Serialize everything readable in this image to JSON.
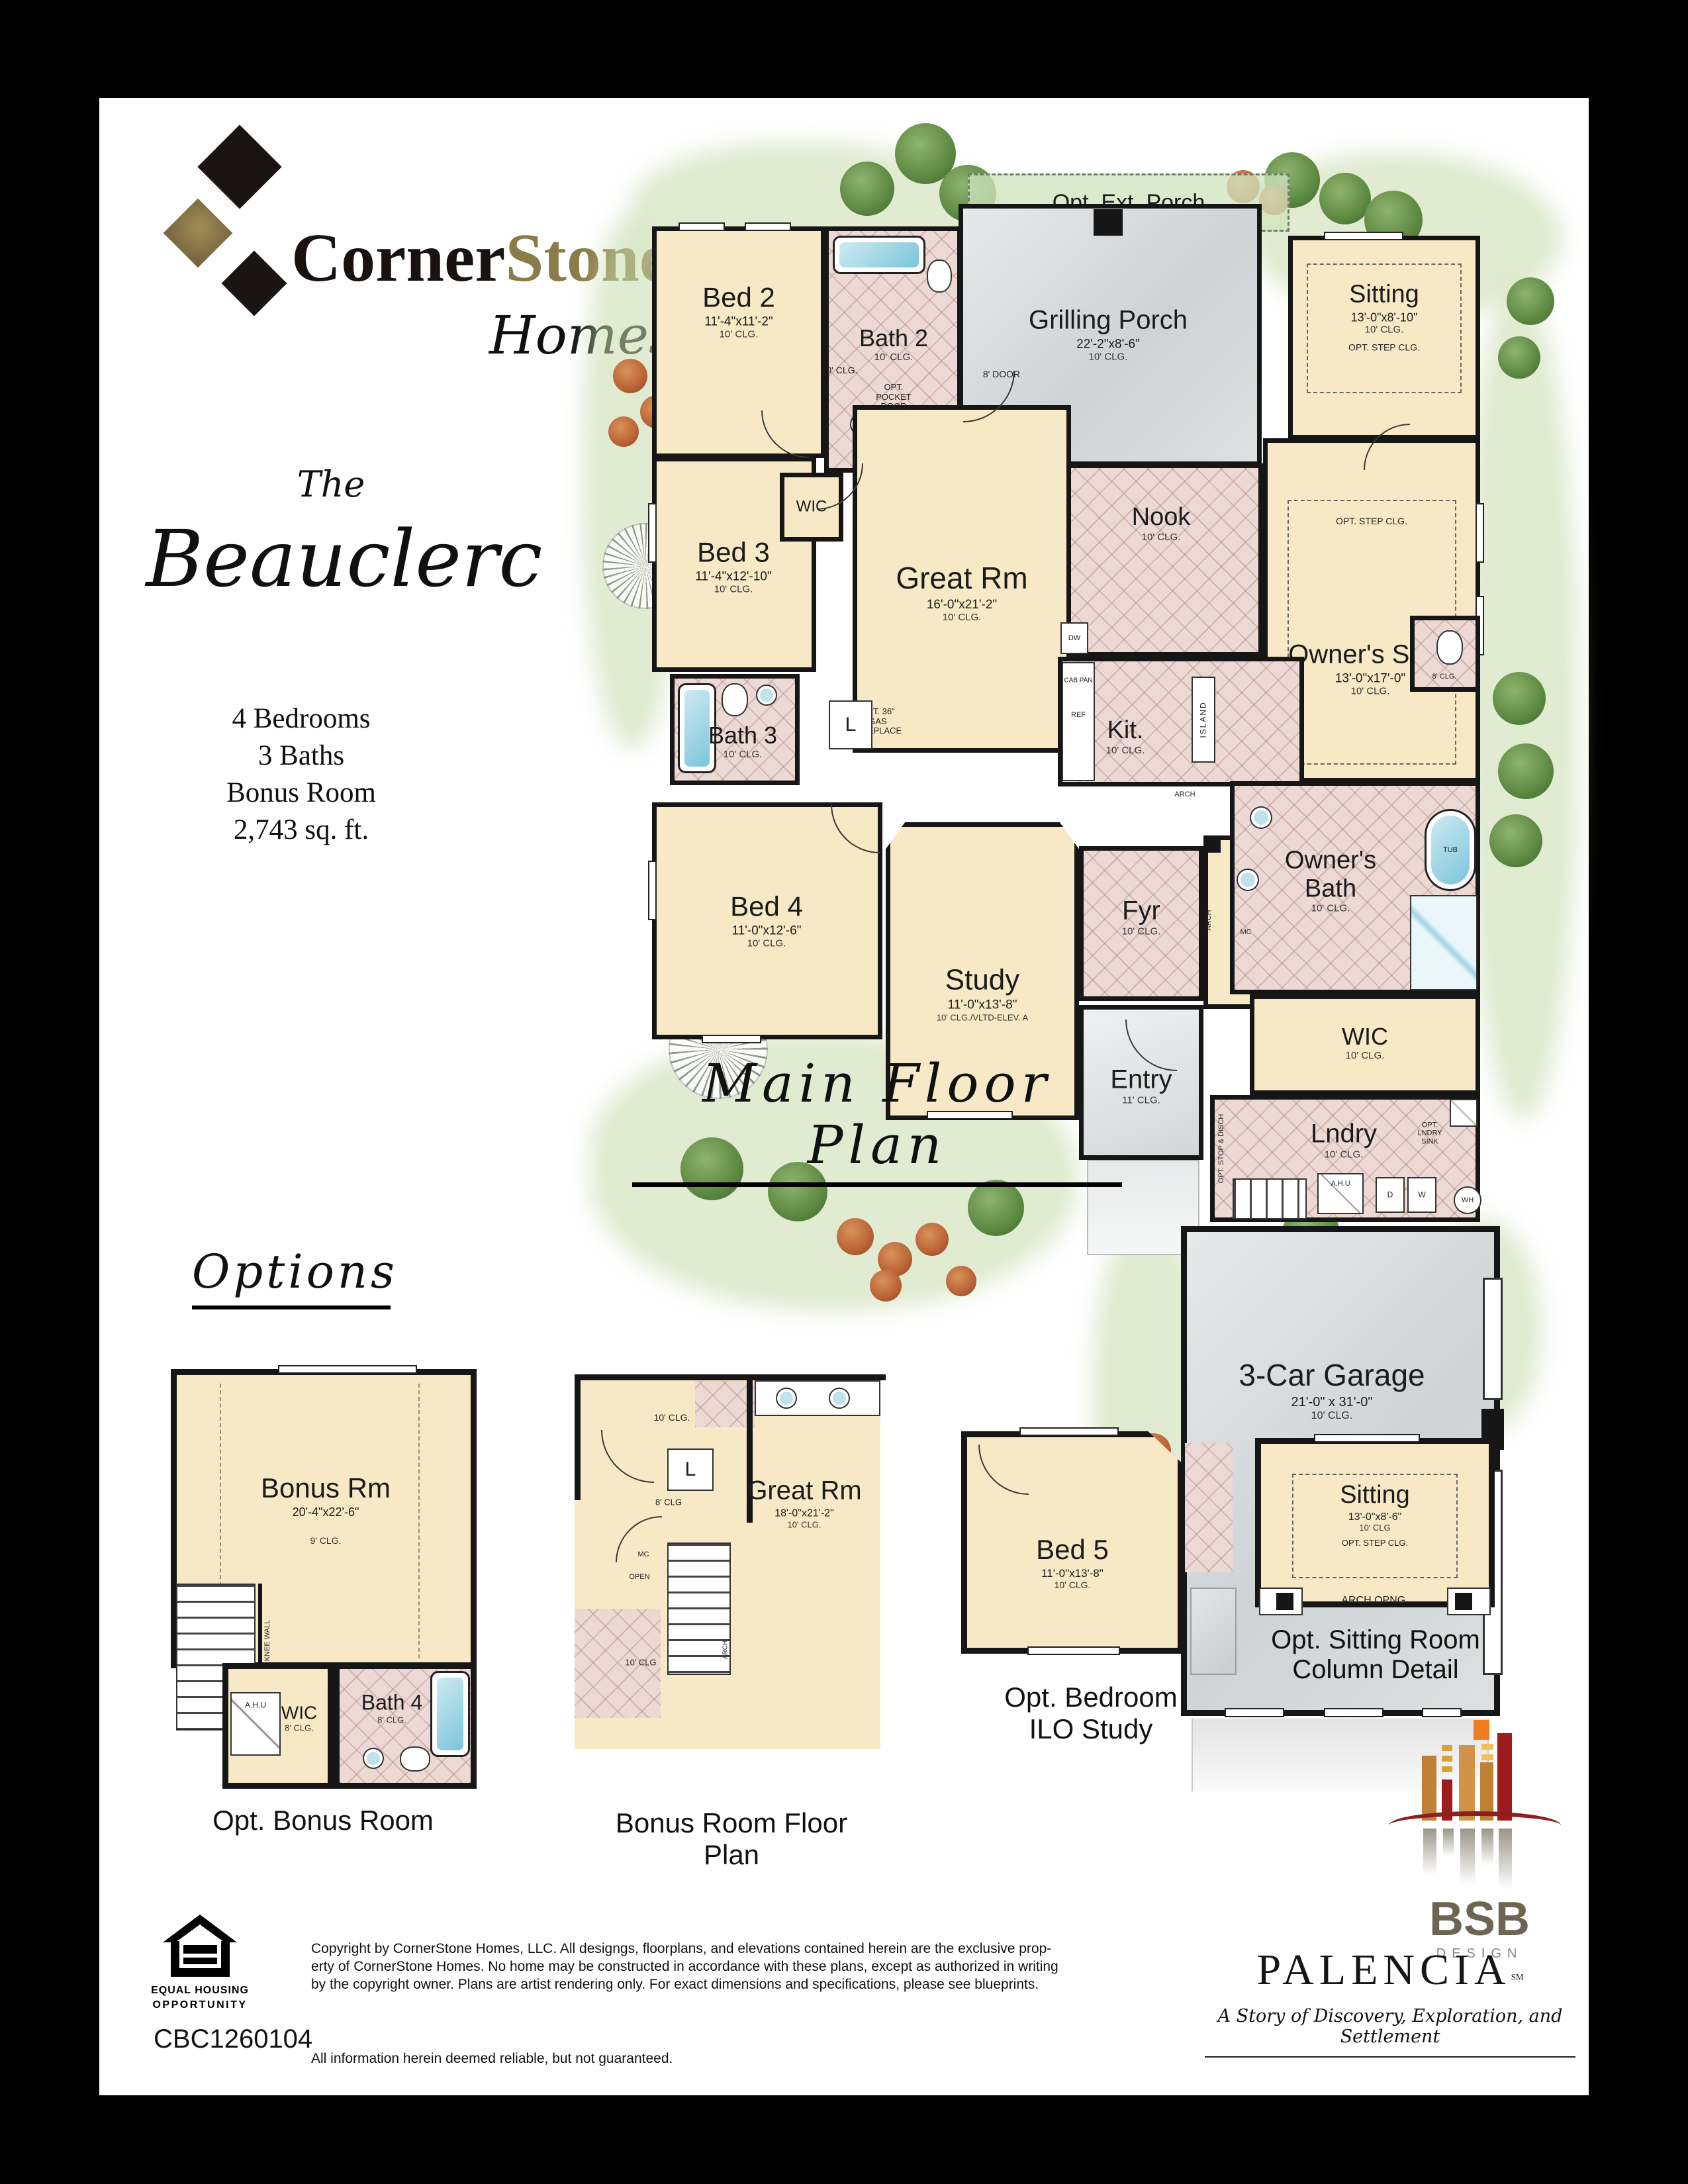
{
  "logo": {
    "corner": "Corner",
    "stone": "Stone",
    "homes": "Homes"
  },
  "title": {
    "the": "The",
    "name": "Beauclerc",
    "spec1": "4 Bedrooms",
    "spec2": "3 Baths",
    "spec3": "Bonus Room",
    "spec4": "2,743 sq. ft."
  },
  "headings": {
    "main": "Main Floor Plan",
    "options": "Options"
  },
  "plan": {
    "opt_ext_porch": "Opt. Ext. Porch",
    "grilling": {
      "name": "Grilling Porch",
      "dims": "22'-2\"x8'-6\"",
      "clg": "10' CLG."
    },
    "door8": "8' DOOR",
    "bed2": {
      "name": "Bed 2",
      "dims": "11'-4\"x11'-2\"",
      "clg": "10' CLG."
    },
    "bath2": {
      "name": "Bath 2",
      "clg": "10' CLG."
    },
    "sitting": {
      "name": "Sitting",
      "dims": "13'-0\"x8'-10\"",
      "clg": "10' CLG.",
      "opt": "OPT. STEP CLG."
    },
    "nook": {
      "name": "Nook",
      "clg": "10' CLG."
    },
    "suite": {
      "name": "Owner's Suite",
      "dims": "13'-0\"x17'-0\"",
      "clg": "10' CLG.",
      "opt": "OPT. STEP CLG."
    },
    "bed3": {
      "name": "Bed 3",
      "dims": "11'-4\"x12'-10\"",
      "clg": "10' CLG."
    },
    "wic_small": "WIC",
    "great": {
      "name": "Great Rm",
      "dims": "16'-0\"x21'-2\"",
      "clg": "10' CLG."
    },
    "pocket1": "OPT.",
    "pocket2": "POCKET",
    "pocket3": "DOOR",
    "fire1": "OPT. 36\"",
    "fire2": "GAS",
    "fire3": "FIREPLACE",
    "hall_clg": "10' CLG.",
    "linen": "L",
    "kit": {
      "name": "Kit.",
      "clg": "10' CLG.",
      "island": "ISLAND",
      "dw": "DW",
      "ref": "REF",
      "cab": "CAB PAN"
    },
    "bath3": {
      "name": "Bath 3",
      "clg": "10' CLG."
    },
    "bed4": {
      "name": "Bed 4",
      "dims": "11'-0\"x12'-6\"",
      "clg": "10' CLG."
    },
    "study": {
      "name": "Study",
      "dims": "11'-0\"x13'-8\"",
      "clg": "10' CLG./VLTD-ELEV. A"
    },
    "fyr": {
      "name": "Fyr",
      "clg": "10' CLG."
    },
    "dining": {
      "name": "Dining Rm",
      "dims": "10'-10\"x11'-6\"",
      "clg": "10' CLG."
    },
    "entry": {
      "name": "Entry",
      "clg": "11' CLG."
    },
    "obath": {
      "name1": "Owner's",
      "name2": "Bath",
      "clg": "10' CLG.",
      "tub": "TUB",
      "mc": "MC",
      "wc_clg": "8' CLG."
    },
    "wic": {
      "name": "WIC",
      "clg": "10' CLG."
    },
    "lndry": {
      "name": "Lndry",
      "clg": "10' CLG.",
      "sink1": "OPT.",
      "sink2": "LNDRY",
      "sink3": "SINK",
      "ahu": "A.H.U",
      "d": "D",
      "w": "W",
      "wh": "WH",
      "stop": "OPT. STOP & DISCH"
    },
    "arch": "ARCH",
    "garage": {
      "name": "3-Car Garage",
      "dims": "21'-0\" x 31'-0\"",
      "clg": "10' CLG."
    }
  },
  "opts": {
    "bonus": {
      "name": "Bonus Rm",
      "dims": "20'-4\"x22'-6\"",
      "clg": "9' CLG.",
      "knee": "KNEE WALL",
      "wic": "WIC",
      "wic_clg": "8' CLG.",
      "ahu": "A.H.U",
      "bath": "Bath 4",
      "bath_clg": "8' CLG.",
      "caption": "Opt. Bonus Room"
    },
    "bonusplan": {
      "clg_top": "10' CLG.",
      "linen": "L",
      "clg8": "8' CLG",
      "great": "Great Rm",
      "dims": "18'-0\"x21'-2\"",
      "clg": "10' CLG.",
      "mc": "MC",
      "open": "OPEN",
      "clg_bottom": "10' CLG",
      "arch": "ARCH",
      "caption1": "Bonus Room Floor",
      "caption2": "Plan"
    },
    "bed5": {
      "name": "Bed 5",
      "dims": "11'-0\"x13'-8\"",
      "clg": "10' CLG.",
      "caption1": "Opt. Bedroom",
      "caption2": "ILO Study"
    },
    "sitdetail": {
      "name": "Sitting",
      "dims": "13'-0\"x8'-6\"",
      "clg": "10' CLG",
      "opt": "OPT. STEP CLG.",
      "arch": "ARCH OPNG.",
      "caption1": "Opt. Sitting Room",
      "caption2": "Column Detail"
    }
  },
  "bsb": {
    "name": "BSB",
    "sub": "DESIGN"
  },
  "footer": {
    "eho1": "EQUAL HOUSING",
    "eho2": "OPPORTUNITY",
    "license": "CBC1260104",
    "copy1": "Copyright by CornerStone Homes, LLC.  All designgs, floorplans, and elevations contained herein are the exclusive prop-",
    "copy2": "erty of CornerStone Homes.  No home may be constructed in accordance with these plans, except as authorized in writing",
    "copy3": "by the copyright owner.  Plans are artist rendering only.  For exact dimensions and specifications, please see blueprints.",
    "reliable": "All information herein deemed reliable, but not guaranteed.",
    "palencia": "PALENCIA",
    "palencia_sm": "SM",
    "tagline": "A Story of Discovery, Exploration, and Settlement"
  }
}
